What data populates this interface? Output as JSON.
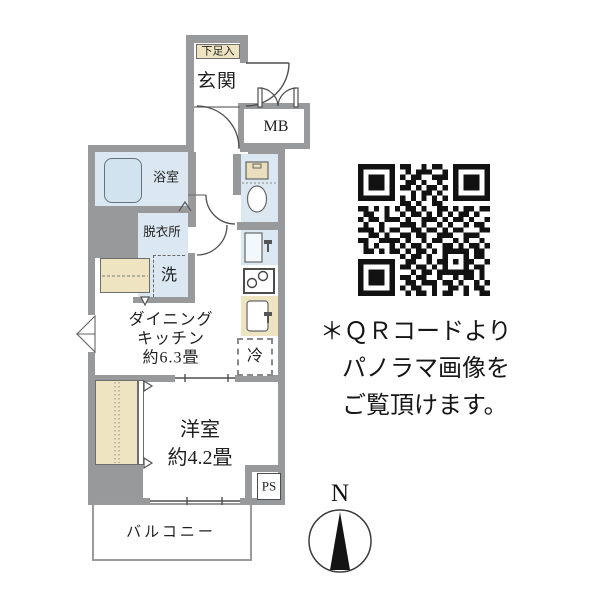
{
  "plan": {
    "shoe_box": "下足入",
    "genkan": "玄関",
    "mb": "MB",
    "bathroom": "浴室",
    "dressing": "脱衣所",
    "washer": "洗",
    "dk_line1": "ダイニング",
    "dk_line2": "キッチン",
    "dk_line3": "約6.3畳",
    "fridge": "冷",
    "western_line1": "洋室",
    "western_line2": "約4.2畳",
    "ps": "PS",
    "balcony": "バルコニー"
  },
  "note": {
    "line1": "＊ＱＲコードより",
    "line2": "パノラマ画像を",
    "line3": "ご覧頂けます。"
  },
  "compass": {
    "north": "N"
  },
  "colors": {
    "wall": "#98999b",
    "water_blue": "#dbe8f2",
    "wood_beige": "#efe4c2",
    "line": "#555555",
    "qr_black": "#121212"
  },
  "qr": {
    "matrix": [
      "1111111011001011001111111",
      "1000001001011100101000001",
      "1011101010110011101011101",
      "1011101001101001001011101",
      "1011101011010110101011101",
      "1000001000101101001000001",
      "1111111010101010101111111",
      "0000000011010011000000000",
      "1101010101101001101011011",
      "0110010010110101010110100",
      "1011011101001110101101001",
      "0100100011101001010010110",
      "1110101100110110101100011",
      "0011010011011001110011100",
      "1100111101001011001010010",
      "0101001010110100110101101",
      "0110101101011010111110110",
      "0000000010110100100010110",
      "1111111001100101101011001",
      "1000001011011010100010110",
      "1011101000101101111111010",
      "1011101011011001001011010",
      "1011101001101110110100101",
      "1000001010110010011010110",
      "1111111001011010110010011"
    ]
  }
}
